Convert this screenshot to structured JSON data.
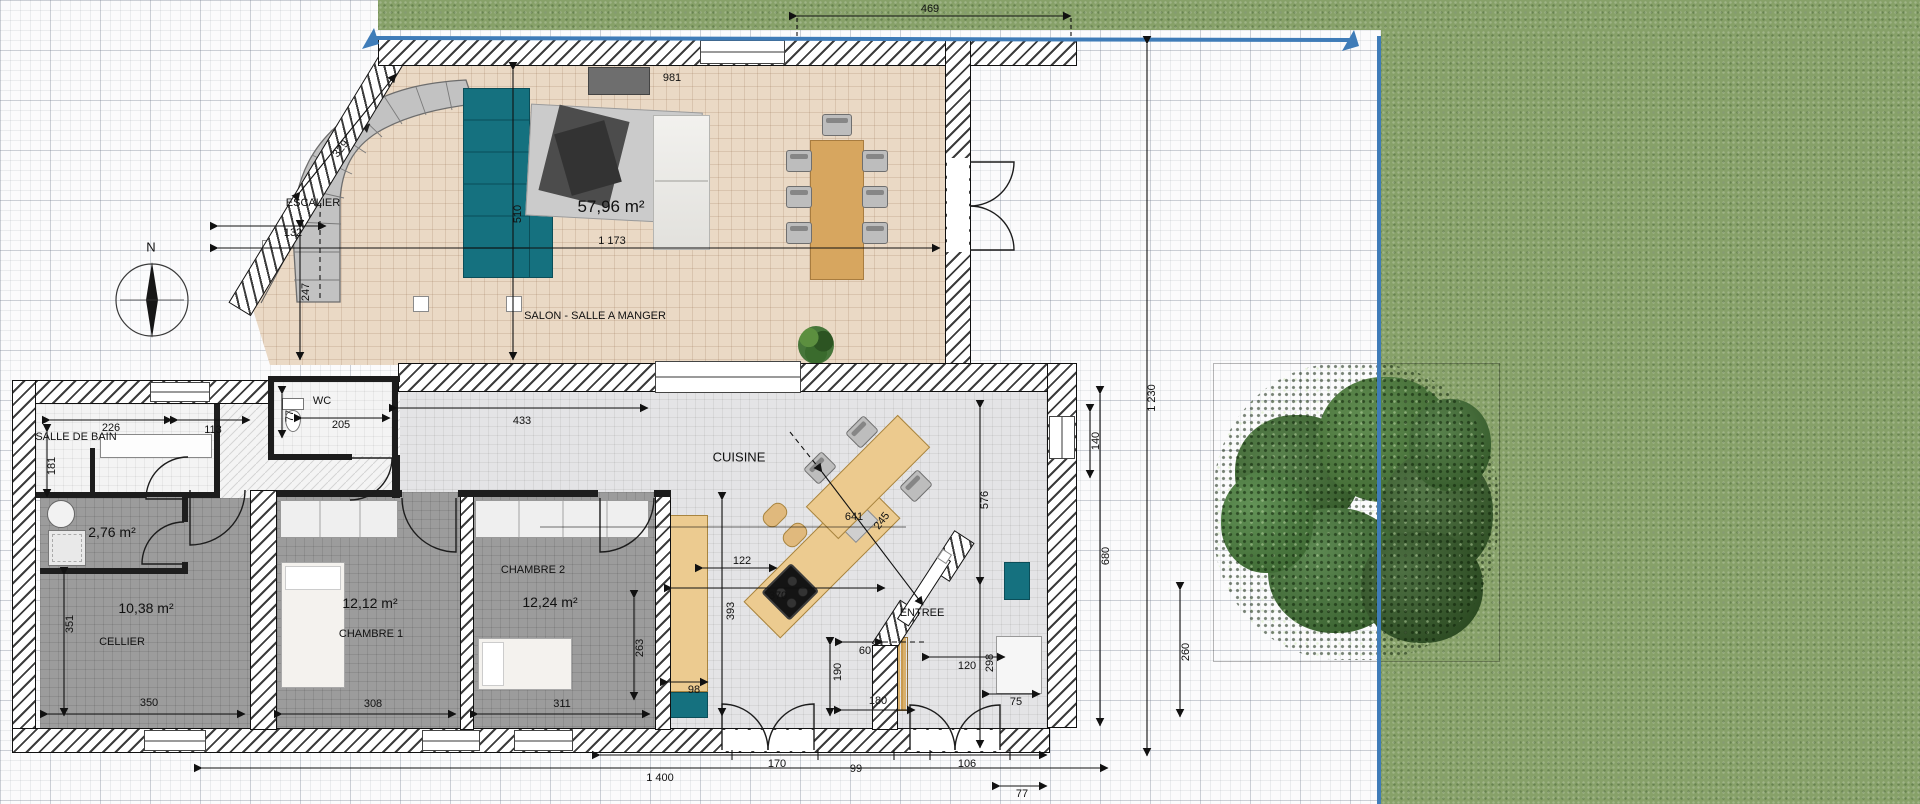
{
  "app": {
    "view": "floor-plan-editor-canvas"
  },
  "colors": {
    "grass": "#87a169",
    "boundary_blue": "#3f7cb8",
    "salon_floor": "#ead9c5",
    "kitchen_floor": "#e4e4e6",
    "dark_room_floor": "#9c9c9c",
    "sofa_teal": "#15717f",
    "wood": "#d7a65f",
    "island_wood": "#eccb90",
    "tree_green": "#3f7030",
    "wall_hatch": "#3c3c3c"
  },
  "rooms": [
    {
      "name": "SALON - SALLE A MANGER",
      "area": "57,96 m²"
    },
    {
      "name": "CUISINE",
      "area": ""
    },
    {
      "name": "ESCALIER",
      "area": ""
    },
    {
      "name": "WC",
      "area": ""
    },
    {
      "name": "SALLE DE BAIN",
      "area": ""
    },
    {
      "name": "CELLIER",
      "area": "10,38 m²"
    },
    {
      "name": "CHAMBRE 1",
      "area": "12,12 m²"
    },
    {
      "name": "CHAMBRE 2",
      "area": "12,24 m²"
    },
    {
      "name": "ENTREE",
      "area": ""
    },
    {
      "name": "",
      "area": "2,76 m²"
    }
  ],
  "compass": {
    "label": "N"
  },
  "plan": {
    "room_labels": [
      {
        "id": "salon-name",
        "text": "SALON - SALLE A MANGER",
        "x": 595,
        "y": 316,
        "size": 11
      },
      {
        "id": "salon-area",
        "text": "57,96 m²",
        "x": 611,
        "y": 207,
        "size": 17
      },
      {
        "id": "escalier",
        "text": "ESCALIER",
        "x": 313,
        "y": 203,
        "size": 11
      },
      {
        "id": "wc",
        "text": "WC",
        "x": 322,
        "y": 401,
        "size": 11
      },
      {
        "id": "salle-de-bain",
        "text": "SALLE DE BAIN",
        "x": 76,
        "y": 437,
        "size": 11
      },
      {
        "id": "cuisine",
        "text": "CUISINE",
        "x": 739,
        "y": 457,
        "size": 13
      },
      {
        "id": "entree",
        "text": "ENTREE",
        "x": 922,
        "y": 613,
        "size": 11
      },
      {
        "id": "cellier",
        "text": "CELLIER",
        "x": 122,
        "y": 642,
        "size": 11
      },
      {
        "id": "cellier-area",
        "text": "10,38 m²",
        "x": 146,
        "y": 608,
        "size": 14
      },
      {
        "id": "chambre1",
        "text": "CHAMBRE 1",
        "x": 371,
        "y": 634,
        "size": 11
      },
      {
        "id": "chambre1-area",
        "text": "12,12 m²",
        "x": 370,
        "y": 603,
        "size": 14
      },
      {
        "id": "chambre2",
        "text": "CHAMBRE 2",
        "x": 533,
        "y": 570,
        "size": 11
      },
      {
        "id": "chambre2-area",
        "text": "12,24 m²",
        "x": 550,
        "y": 602,
        "size": 14
      },
      {
        "id": "petite-piece-area",
        "text": "2,76 m²",
        "x": 112,
        "y": 532,
        "size": 14
      },
      {
        "id": "north",
        "text": "N",
        "x": 151,
        "y": 247,
        "size": 13
      }
    ],
    "dim_labels": [
      {
        "text": "469",
        "x": 930,
        "y": 9
      },
      {
        "text": "981",
        "x": 672,
        "y": 78
      },
      {
        "text": "1 173",
        "x": 612,
        "y": 241
      },
      {
        "text": "510",
        "x": 518,
        "y": 214,
        "rot": -90
      },
      {
        "text": "329",
        "x": 341,
        "y": 149,
        "rot": -51
      },
      {
        "text": "132",
        "x": 293,
        "y": 233
      },
      {
        "text": "247",
        "x": 306,
        "y": 292,
        "rot": -90
      },
      {
        "text": "226",
        "x": 111,
        "y": 428
      },
      {
        "text": "113",
        "x": 213,
        "y": 430
      },
      {
        "text": "181",
        "x": 52,
        "y": 466,
        "rot": -90
      },
      {
        "text": "77",
        "x": 290,
        "y": 416,
        "rot": -90
      },
      {
        "text": "205",
        "x": 341,
        "y": 425
      },
      {
        "text": "433",
        "x": 522,
        "y": 421
      },
      {
        "text": "641",
        "x": 854,
        "y": 517
      },
      {
        "text": "245",
        "x": 882,
        "y": 521,
        "rot": -53
      },
      {
        "text": "122",
        "x": 742,
        "y": 561
      },
      {
        "text": "370",
        "x": 778,
        "y": 596
      },
      {
        "text": "393",
        "x": 731,
        "y": 611,
        "rot": -90
      },
      {
        "text": "263",
        "x": 640,
        "y": 648,
        "rot": -90
      },
      {
        "text": "98",
        "x": 694,
        "y": 690
      },
      {
        "text": "351",
        "x": 70,
        "y": 624,
        "rot": -90
      },
      {
        "text": "350",
        "x": 149,
        "y": 703
      },
      {
        "text": "308",
        "x": 373,
        "y": 704
      },
      {
        "text": "311",
        "x": 562,
        "y": 704
      },
      {
        "text": "60",
        "x": 865,
        "y": 651
      },
      {
        "text": "190",
        "x": 838,
        "y": 672,
        "rot": -90
      },
      {
        "text": "180",
        "x": 878,
        "y": 701
      },
      {
        "text": "120",
        "x": 967,
        "y": 666
      },
      {
        "text": "75",
        "x": 1016,
        "y": 702
      },
      {
        "text": "298",
        "x": 990,
        "y": 663,
        "rot": -90
      },
      {
        "text": "576",
        "x": 985,
        "y": 500,
        "rot": -90
      },
      {
        "text": "140",
        "x": 1096,
        "y": 441,
        "rot": -90
      },
      {
        "text": "680",
        "x": 1106,
        "y": 556,
        "rot": -90
      },
      {
        "text": "260",
        "x": 1186,
        "y": 652,
        "rot": -90
      },
      {
        "text": "1 230",
        "x": 1152,
        "y": 398,
        "rot": -90
      },
      {
        "text": "1 400",
        "x": 660,
        "y": 778
      },
      {
        "text": "170",
        "x": 777,
        "y": 764
      },
      {
        "text": "99",
        "x": 856,
        "y": 769
      },
      {
        "text": "106",
        "x": 967,
        "y": 764
      },
      {
        "text": "77",
        "x": 1022,
        "y": 794
      }
    ]
  }
}
